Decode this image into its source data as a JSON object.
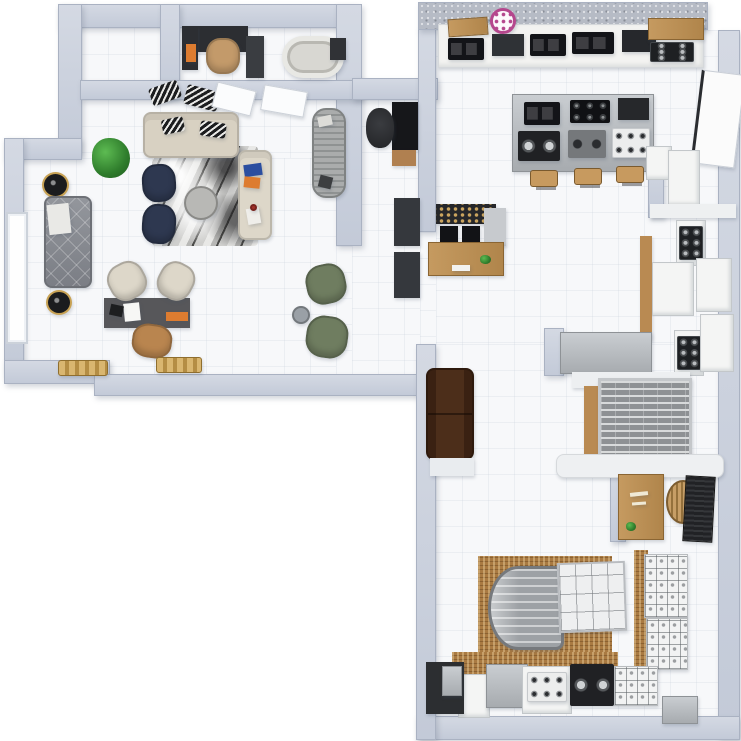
{
  "scene": {
    "title": "3D Apartment Showroom Floor Plan — Top-Down Render",
    "canvas": {
      "w": 741,
      "h": 741
    }
  },
  "palette": {
    "wall": "#c3cad8",
    "wallLight": "#d4d9e3",
    "floor": "#f7f8fa",
    "outside": "#ffffff",
    "charcoal": "#2c2e32",
    "orange": "#dd7c30",
    "tan": "#c39a6a",
    "navy": "#2e3850",
    "beige": "#d8d1c2",
    "cream": "#ddd7c9",
    "blue": "#2b4ea0",
    "olive": "#6f7d60",
    "wood": "#b98a52",
    "pink": "#b5478d",
    "brown": "#4c2e1a",
    "steel": "#b0b4b8"
  },
  "floors": [
    {
      "name": "floor-closet",
      "x": 82,
      "y": 28,
      "w": 78,
      "h": 52
    },
    {
      "name": "floor-office-bath",
      "x": 180,
      "y": 28,
      "w": 156,
      "h": 52
    },
    {
      "name": "floor-living-upper",
      "x": 82,
      "y": 100,
      "w": 254,
      "h": 58
    },
    {
      "name": "floor-living",
      "x": 24,
      "y": 158,
      "w": 312,
      "h": 216
    },
    {
      "name": "floor-passage",
      "x": 336,
      "y": 246,
      "w": 16,
      "h": 128
    },
    {
      "name": "floor-hall",
      "x": 352,
      "y": 100,
      "w": 68,
      "h": 274
    },
    {
      "name": "floor-kitchen",
      "x": 436,
      "y": 30,
      "w": 282,
      "h": 314
    },
    {
      "name": "floor-kitchen-west",
      "x": 420,
      "y": 232,
      "w": 16,
      "h": 112
    },
    {
      "name": "floor-lower-room",
      "x": 436,
      "y": 344,
      "w": 282,
      "h": 372
    }
  ],
  "walls": [
    {
      "name": "wall-top-left",
      "x": 58,
      "y": 4,
      "w": 296,
      "h": 24
    },
    {
      "name": "wall-left-upper",
      "x": 58,
      "y": 4,
      "w": 24,
      "h": 150
    },
    {
      "name": "wall-left-step",
      "x": 4,
      "y": 138,
      "w": 78,
      "h": 22
    },
    {
      "name": "wall-left-lower",
      "x": 4,
      "y": 138,
      "w": 20,
      "h": 238
    },
    {
      "name": "wall-bottom-left",
      "x": 4,
      "y": 360,
      "w": 106,
      "h": 24
    },
    {
      "name": "wall-living-bottom",
      "x": 94,
      "y": 374,
      "w": 342,
      "h": 22
    },
    {
      "name": "wall-living-right",
      "x": 336,
      "y": 4,
      "w": 26,
      "h": 242
    },
    {
      "name": "wall-closet-divider",
      "x": 160,
      "y": 4,
      "w": 20,
      "h": 96
    },
    {
      "name": "wall-toprooms-bottom",
      "x": 80,
      "y": 80,
      "w": 282,
      "h": 20
    },
    {
      "name": "wall-hall-top",
      "x": 352,
      "y": 78,
      "w": 86,
      "h": 22
    },
    {
      "name": "wall-kitchen-left",
      "x": 418,
      "y": 28,
      "w": 18,
      "h": 204
    },
    {
      "name": "wall-kitchen-top",
      "x": 418,
      "y": 2,
      "w": 290,
      "h": 28,
      "texture": "granite"
    },
    {
      "name": "wall-right-main",
      "x": 718,
      "y": 30,
      "w": 22,
      "h": 708
    },
    {
      "name": "wall-bottom-main",
      "x": 416,
      "y": 716,
      "w": 324,
      "h": 24
    },
    {
      "name": "wall-lower-left",
      "x": 416,
      "y": 344,
      "w": 20,
      "h": 396
    },
    {
      "name": "wall-corridor-inner",
      "x": 648,
      "y": 148,
      "w": 16,
      "h": 70
    },
    {
      "name": "wall-kitchen-stub",
      "x": 544,
      "y": 328,
      "w": 20,
      "h": 48
    },
    {
      "name": "wall-desk-nook",
      "x": 610,
      "y": 468,
      "w": 16,
      "h": 74
    }
  ],
  "furniture": [
    {
      "name": "office-desk",
      "x": 182,
      "y": 26,
      "w": 66,
      "h": 26,
      "color": "charcoal"
    },
    {
      "name": "office-desk-return",
      "x": 182,
      "y": 26,
      "w": 16,
      "h": 44,
      "color": "charcoal"
    },
    {
      "name": "office-books-orange",
      "x": 186,
      "y": 44,
      "w": 10,
      "h": 18,
      "color": "orange"
    },
    {
      "name": "office-chair-tan",
      "x": 206,
      "y": 38,
      "w": 34,
      "h": 36,
      "color": "tan",
      "type": "seat"
    },
    {
      "name": "bath-vanity",
      "x": 246,
      "y": 36,
      "w": 18,
      "h": 42,
      "color": "#3a3d41"
    },
    {
      "name": "bathtub",
      "x": 282,
      "y": 36,
      "w": 62,
      "h": 42,
      "type": "tub"
    },
    {
      "name": "bath-cabinet",
      "x": 330,
      "y": 38,
      "w": 16,
      "h": 22,
      "color": "#303236"
    },
    {
      "name": "wall-art-1",
      "x": 150,
      "y": 84,
      "w": 30,
      "h": 18,
      "type": "patterned-dark",
      "rot": -20
    },
    {
      "name": "wall-art-2",
      "x": 185,
      "y": 88,
      "w": 34,
      "h": 20,
      "type": "patterned-dark",
      "rot": 15
    },
    {
      "name": "door-leaf-1",
      "x": 214,
      "y": 86,
      "w": 40,
      "h": 26,
      "type": "panel",
      "rot": 14
    },
    {
      "name": "door-leaf-2",
      "x": 262,
      "y": 88,
      "w": 44,
      "h": 26,
      "type": "panel",
      "rot": 10
    },
    {
      "name": "living-rug-marble",
      "x": 152,
      "y": 146,
      "w": 106,
      "h": 100,
      "type": "marble"
    },
    {
      "name": "sofa-beige",
      "x": 143,
      "y": 112,
      "w": 96,
      "h": 46,
      "color": "beige",
      "type": "sofa"
    },
    {
      "name": "sofa-pillow-1",
      "x": 162,
      "y": 118,
      "w": 22,
      "h": 15,
      "type": "patterned-dark",
      "rot": -12
    },
    {
      "name": "sofa-pillow-2",
      "x": 200,
      "y": 122,
      "w": 26,
      "h": 15,
      "type": "patterned-dark",
      "rot": 8
    },
    {
      "name": "armchair-navy-1",
      "x": 142,
      "y": 164,
      "w": 34,
      "h": 38,
      "color": "navy",
      "type": "seat",
      "rot": -4
    },
    {
      "name": "armchair-navy-2",
      "x": 142,
      "y": 204,
      "w": 34,
      "h": 40,
      "color": "navy",
      "type": "seat",
      "rot": 4
    },
    {
      "name": "coffee-table-round",
      "x": 184,
      "y": 186,
      "w": 34,
      "h": 34,
      "color": "#b8b8b5",
      "type": "round"
    },
    {
      "name": "bench-cream",
      "x": 238,
      "y": 150,
      "w": 34,
      "h": 90,
      "color": "cream",
      "type": "sofa"
    },
    {
      "name": "bench-item-blue",
      "x": 244,
      "y": 164,
      "w": 18,
      "h": 12,
      "color": "blue",
      "rot": -8
    },
    {
      "name": "bench-item-orange",
      "x": 244,
      "y": 177,
      "w": 16,
      "h": 11,
      "color": "orange",
      "rot": 6
    },
    {
      "name": "bench-bottle",
      "x": 247,
      "y": 208,
      "w": 13,
      "h": 16,
      "color": "#efeeea",
      "rot": -10
    },
    {
      "name": "bench-bottle-cap",
      "x": 250,
      "y": 204,
      "w": 7,
      "h": 7,
      "color": "#a23028",
      "type": "round"
    },
    {
      "name": "potted-plant",
      "x": 92,
      "y": 138,
      "w": 38,
      "h": 40,
      "type": "plant"
    },
    {
      "name": "side-table-black-1",
      "x": 42,
      "y": 172,
      "w": 27,
      "h": 26,
      "type": "table-black"
    },
    {
      "name": "sofa-gray-tufted",
      "x": 44,
      "y": 196,
      "w": 48,
      "h": 92,
      "type": "tufted"
    },
    {
      "name": "sofa-gray-throw",
      "x": 48,
      "y": 204,
      "w": 22,
      "h": 30,
      "color": "#e9e9e6",
      "rot": -6
    },
    {
      "name": "side-table-black-2",
      "x": 46,
      "y": 290,
      "w": 26,
      "h": 25,
      "type": "table-black"
    },
    {
      "name": "left-window",
      "x": 6,
      "y": 212,
      "w": 22,
      "h": 132,
      "type": "window"
    },
    {
      "name": "writing-desk",
      "x": 104,
      "y": 298,
      "w": 86,
      "h": 30,
      "color": "#57575a"
    },
    {
      "name": "desk-paper",
      "x": 124,
      "y": 303,
      "w": 16,
      "h": 18,
      "color": "#f7f7f5",
      "rot": -6
    },
    {
      "name": "desk-laptop",
      "x": 110,
      "y": 305,
      "w": 13,
      "h": 11,
      "color": "#1d1e20",
      "rot": 12
    },
    {
      "name": "desk-logo-strip",
      "x": 166,
      "y": 312,
      "w": 22,
      "h": 9,
      "color": "orange"
    },
    {
      "name": "desk-chair-cream-1",
      "x": 108,
      "y": 262,
      "w": 38,
      "h": 38,
      "color": "cream",
      "type": "seat",
      "rot": -28
    },
    {
      "name": "desk-chair-cream-2",
      "x": 158,
      "y": 262,
      "w": 36,
      "h": 38,
      "color": "cream",
      "type": "seat",
      "rot": 28
    },
    {
      "name": "desk-chair-tan",
      "x": 132,
      "y": 324,
      "w": 40,
      "h": 34,
      "color": "#b9854f",
      "type": "seat",
      "rot": 8
    },
    {
      "name": "gold-bench-1",
      "x": 58,
      "y": 360,
      "w": 50,
      "h": 16,
      "type": "gold"
    },
    {
      "name": "gold-bench-2",
      "x": 156,
      "y": 357,
      "w": 46,
      "h": 16,
      "type": "gold"
    },
    {
      "name": "armchair-green-1",
      "x": 306,
      "y": 264,
      "w": 40,
      "h": 40,
      "color": "olive",
      "type": "seat",
      "rot": -12
    },
    {
      "name": "armchair-green-2",
      "x": 306,
      "y": 316,
      "w": 42,
      "h": 42,
      "color": "olive",
      "type": "seat",
      "rot": 8
    },
    {
      "name": "floor-sculpture",
      "x": 292,
      "y": 306,
      "w": 18,
      "h": 18,
      "color": "#9aa0a6",
      "type": "round"
    },
    {
      "name": "chaise-ribbed",
      "x": 312,
      "y": 108,
      "w": 34,
      "h": 90,
      "type": "ribbed"
    },
    {
      "name": "chaise-item-1",
      "x": 318,
      "y": 116,
      "w": 14,
      "h": 10,
      "color": "#dcdcd8",
      "rot": -12
    },
    {
      "name": "chaise-item-2",
      "x": 319,
      "y": 176,
      "w": 13,
      "h": 12,
      "color": "#3c3e40",
      "rot": 14
    },
    {
      "name": "hall-desk",
      "x": 392,
      "y": 102,
      "w": 26,
      "h": 48,
      "color": "#16171a"
    },
    {
      "name": "hall-drawers",
      "x": 392,
      "y": 150,
      "w": 24,
      "h": 16,
      "color": "#b08050"
    },
    {
      "name": "hall-office-chair",
      "x": 366,
      "y": 108,
      "w": 28,
      "h": 40,
      "type": "office-chair"
    },
    {
      "name": "hall-cabinet-1",
      "x": 394,
      "y": 198,
      "w": 26,
      "h": 48,
      "color": "#35383d"
    },
    {
      "name": "hall-cabinet-2",
      "x": 394,
      "y": 252,
      "w": 26,
      "h": 46,
      "color": "#35383d"
    },
    {
      "name": "kitchen-counter-main",
      "x": 438,
      "y": 24,
      "w": 266,
      "h": 44,
      "color": "#f3f3f1",
      "type": "counter"
    },
    {
      "name": "cutting-board-wood",
      "x": 448,
      "y": 18,
      "w": 40,
      "h": 18,
      "type": "wood",
      "rot": -4
    },
    {
      "name": "cooktop-a",
      "x": 448,
      "y": 38,
      "w": 36,
      "h": 22,
      "type": "hob-black"
    },
    {
      "name": "cooktop-b",
      "x": 492,
      "y": 34,
      "w": 32,
      "h": 22,
      "color": "#2f3236"
    },
    {
      "name": "cooktop-c",
      "x": 530,
      "y": 34,
      "w": 36,
      "h": 22,
      "type": "hob-black"
    },
    {
      "name": "cooktop-d",
      "x": 572,
      "y": 32,
      "w": 42,
      "h": 22,
      "type": "hob-black"
    },
    {
      "name": "hood-unit",
      "x": 622,
      "y": 30,
      "w": 34,
      "h": 22,
      "color": "#26282c"
    },
    {
      "name": "wood-shelf-top",
      "x": 648,
      "y": 18,
      "w": 56,
      "h": 22,
      "type": "wood"
    },
    {
      "name": "gas-cooktop-top",
      "x": 650,
      "y": 42,
      "w": 44,
      "h": 20,
      "type": "burners-dark"
    },
    {
      "name": "brand-watermark-icon",
      "x": 490,
      "y": 8,
      "w": 26,
      "h": 26,
      "type": "logo"
    },
    {
      "name": "island",
      "x": 512,
      "y": 94,
      "w": 142,
      "h": 78,
      "type": "steel"
    },
    {
      "name": "island-hob-1",
      "x": 524,
      "y": 102,
      "w": 36,
      "h": 23,
      "type": "hob-black"
    },
    {
      "name": "island-hob-2",
      "x": 570,
      "y": 100,
      "w": 40,
      "h": 23,
      "type": "burners-black"
    },
    {
      "name": "island-hob-3",
      "x": 618,
      "y": 98,
      "w": 31,
      "h": 22,
      "color": "#26282b"
    },
    {
      "name": "island-hob-4",
      "x": 518,
      "y": 131,
      "w": 42,
      "h": 30,
      "type": "knob-panel"
    },
    {
      "name": "island-hob-5",
      "x": 568,
      "y": 130,
      "w": 38,
      "h": 28,
      "type": "steel-gas"
    },
    {
      "name": "island-hob-6",
      "x": 612,
      "y": 128,
      "w": 38,
      "h": 30,
      "type": "burners-white"
    },
    {
      "name": "stool-1",
      "x": 530,
      "y": 170,
      "w": 28,
      "h": 17,
      "type": "stool"
    },
    {
      "name": "stool-2",
      "x": 574,
      "y": 168,
      "w": 28,
      "h": 17,
      "type": "stool"
    },
    {
      "name": "stool-3",
      "x": 616,
      "y": 166,
      "w": 28,
      "h": 17,
      "type": "stool"
    },
    {
      "name": "coffee-shelf",
      "x": 436,
      "y": 204,
      "w": 60,
      "h": 20,
      "type": "shelf-bottles"
    },
    {
      "name": "espresso-machine-1",
      "x": 440,
      "y": 226,
      "w": 18,
      "h": 18,
      "color": "#121316"
    },
    {
      "name": "espresso-machine-2",
      "x": 462,
      "y": 226,
      "w": 18,
      "h": 18,
      "color": "#121316"
    },
    {
      "name": "coffee-counter-return",
      "x": 484,
      "y": 208,
      "w": 22,
      "h": 38,
      "color": "#c7cace"
    },
    {
      "name": "coffee-counter-wood",
      "x": 428,
      "y": 242,
      "w": 76,
      "h": 34,
      "type": "wood"
    },
    {
      "name": "coffee-scale",
      "x": 452,
      "y": 265,
      "w": 18,
      "h": 6,
      "color": "#f2f2f0"
    },
    {
      "name": "coffee-plant",
      "x": 480,
      "y": 255,
      "w": 11,
      "h": 9,
      "type": "plant"
    },
    {
      "name": "leaning-door",
      "x": 696,
      "y": 72,
      "w": 44,
      "h": 94,
      "type": "door-panel",
      "rot": 7
    },
    {
      "name": "corridor-fridge-a",
      "x": 646,
      "y": 146,
      "w": 26,
      "h": 34,
      "type": "appliance"
    },
    {
      "name": "corridor-fridge-b",
      "x": 668,
      "y": 150,
      "w": 32,
      "h": 56,
      "type": "appliance"
    },
    {
      "name": "corridor-wood-strip",
      "x": 640,
      "y": 236,
      "w": 12,
      "h": 104,
      "color": "wood"
    },
    {
      "name": "corridor-shelf",
      "x": 650,
      "y": 204,
      "w": 86,
      "h": 14,
      "color": "#eef0f1"
    },
    {
      "name": "range-1-body",
      "x": 676,
      "y": 220,
      "w": 30,
      "h": 46,
      "type": "appliance"
    },
    {
      "name": "range-1-burners",
      "x": 679,
      "y": 226,
      "w": 24,
      "h": 34,
      "type": "burners-dark"
    },
    {
      "name": "corridor-cabinet",
      "x": 652,
      "y": 262,
      "w": 42,
      "h": 54,
      "type": "appliance"
    },
    {
      "name": "corridor-fridge-c",
      "x": 696,
      "y": 258,
      "w": 36,
      "h": 54,
      "type": "appliance"
    },
    {
      "name": "range-2-body",
      "x": 674,
      "y": 330,
      "w": 30,
      "h": 46,
      "type": "appliance"
    },
    {
      "name": "range-2-burners",
      "x": 677,
      "y": 336,
      "w": 24,
      "h": 34,
      "type": "burners-dark"
    },
    {
      "name": "chest-freezer-gray",
      "x": 560,
      "y": 332,
      "w": 92,
      "h": 42,
      "type": "steel"
    },
    {
      "name": "kitchen-ledge",
      "x": 572,
      "y": 372,
      "w": 118,
      "h": 16,
      "color": "#edeff1"
    },
    {
      "name": "corner-fridge",
      "x": 700,
      "y": 314,
      "w": 34,
      "h": 58,
      "type": "appliance"
    },
    {
      "name": "sofa-brown",
      "x": 426,
      "y": 368,
      "w": 48,
      "h": 92,
      "type": "sofa-brown"
    },
    {
      "name": "sofa-brown-ledge",
      "x": 430,
      "y": 458,
      "w": 44,
      "h": 18,
      "color": "#e9ecef"
    },
    {
      "name": "rack-wood-strip",
      "x": 584,
      "y": 386,
      "w": 14,
      "h": 74,
      "color": "wood"
    },
    {
      "name": "wire-rack",
      "x": 598,
      "y": 378,
      "w": 94,
      "h": 84,
      "type": "wire"
    },
    {
      "name": "lower-shelf-white",
      "x": 556,
      "y": 454,
      "w": 168,
      "h": 24,
      "color": "#eef0f2",
      "type": "shelf"
    },
    {
      "name": "reception-desk-wood",
      "x": 618,
      "y": 474,
      "w": 46,
      "h": 66,
      "type": "wood"
    },
    {
      "name": "desk-mark-1",
      "x": 630,
      "y": 492,
      "w": 18,
      "h": 4,
      "color": "#efe9d6",
      "rot": -6
    },
    {
      "name": "desk-mark-2",
      "x": 632,
      "y": 502,
      "w": 14,
      "h": 3,
      "color": "#efe9d6",
      "rot": -4
    },
    {
      "name": "desk-plant-small",
      "x": 626,
      "y": 522,
      "w": 10,
      "h": 9,
      "type": "plant"
    },
    {
      "name": "rattan-chair",
      "x": 666,
      "y": 480,
      "w": 34,
      "h": 44,
      "type": "rattan"
    },
    {
      "name": "dark-blinds",
      "x": 684,
      "y": 476,
      "w": 30,
      "h": 66,
      "type": "blinds",
      "rot": 3
    },
    {
      "name": "cafe-wicker-mat",
      "x": 478,
      "y": 556,
      "w": 134,
      "h": 106,
      "type": "wicker"
    },
    {
      "name": "right-wicker-strip",
      "x": 634,
      "y": 550,
      "w": 14,
      "h": 122,
      "type": "wicker"
    },
    {
      "name": "bottom-wicker-mat",
      "x": 452,
      "y": 652,
      "w": 166,
      "h": 24,
      "type": "wicker"
    },
    {
      "name": "display-case-curved",
      "x": 488,
      "y": 566,
      "w": 76,
      "h": 84,
      "type": "case-curved"
    },
    {
      "name": "display-case-deli",
      "x": 558,
      "y": 562,
      "w": 68,
      "h": 70,
      "type": "case-deli",
      "rot": -2
    },
    {
      "name": "product-shelf-1",
      "x": 644,
      "y": 554,
      "w": 44,
      "h": 64,
      "type": "product-grid"
    },
    {
      "name": "product-shelf-2",
      "x": 646,
      "y": 618,
      "w": 42,
      "h": 52,
      "type": "product-grid"
    },
    {
      "name": "bottom-cabinet-white",
      "x": 458,
      "y": 674,
      "w": 32,
      "h": 44,
      "type": "appliance"
    },
    {
      "name": "steel-chest",
      "x": 486,
      "y": 664,
      "w": 42,
      "h": 44,
      "type": "steel"
    },
    {
      "name": "range-3-body",
      "x": 522,
      "y": 666,
      "w": 50,
      "h": 48,
      "type": "appliance"
    },
    {
      "name": "range-3-burners",
      "x": 527,
      "y": 672,
      "w": 40,
      "h": 30,
      "type": "burners-white"
    },
    {
      "name": "dark-dial-appliance",
      "x": 570,
      "y": 664,
      "w": 44,
      "h": 42,
      "type": "knob-panel"
    },
    {
      "name": "display-box",
      "x": 614,
      "y": 666,
      "w": 44,
      "h": 40,
      "type": "product-grid"
    },
    {
      "name": "steel-box-small",
      "x": 662,
      "y": 696,
      "w": 36,
      "h": 28,
      "type": "steel"
    },
    {
      "name": "corner-sink-unit",
      "x": 426,
      "y": 662,
      "w": 38,
      "h": 52,
      "color": "#2c2e31"
    },
    {
      "name": "sink-basin",
      "x": 442,
      "y": 666,
      "w": 20,
      "h": 30,
      "type": "steel"
    }
  ]
}
